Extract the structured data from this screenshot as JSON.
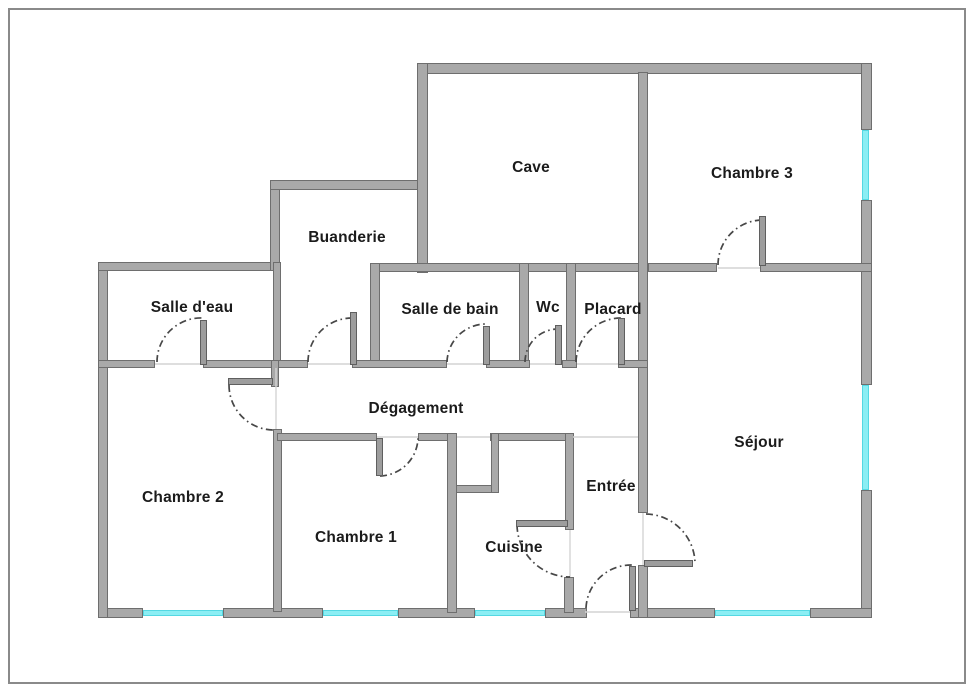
{
  "palette": {
    "wall_fill": "#a9a9a9",
    "wall_edge": "#6e6e6e",
    "window_color": "#8beef4",
    "window_edge": "#54d8e2",
    "arc_color": "#474747",
    "opening_line_color": "#d4d4d4",
    "label_color": "#1b1b1b",
    "frame_color": "#8a8a8a"
  },
  "rooms": [
    {
      "id": "cave",
      "label": "Cave",
      "cx": 531,
      "cy": 168
    },
    {
      "id": "chambre-3",
      "label": "Chambre 3",
      "cx": 752,
      "cy": 174
    },
    {
      "id": "buanderie",
      "label": "Buanderie",
      "cx": 347,
      "cy": 238
    },
    {
      "id": "salle-d-eau",
      "label": "Salle d'eau",
      "cx": 192,
      "cy": 308
    },
    {
      "id": "salle-de-bain",
      "label": "Salle de bain",
      "cx": 450,
      "cy": 310
    },
    {
      "id": "wc",
      "label": "Wc",
      "cx": 548,
      "cy": 308
    },
    {
      "id": "placard",
      "label": "Placard",
      "cx": 613,
      "cy": 310
    },
    {
      "id": "degagement",
      "label": "Dégagement",
      "cx": 416,
      "cy": 409
    },
    {
      "id": "chambre-2",
      "label": "Chambre 2",
      "cx": 183,
      "cy": 498
    },
    {
      "id": "chambre-1",
      "label": "Chambre 1",
      "cx": 356,
      "cy": 538
    },
    {
      "id": "cuisine",
      "label": "Cuisine",
      "cx": 514,
      "cy": 548
    },
    {
      "id": "entree",
      "label": "Entrée",
      "cx": 611,
      "cy": 487
    },
    {
      "id": "sejour",
      "label": "Séjour",
      "cx": 759,
      "cy": 443
    }
  ],
  "plan": {
    "walls": [
      {
        "x": 418,
        "y": 63,
        "w": 454,
        "h": 11
      },
      {
        "x": 861,
        "y": 63,
        "w": 11,
        "h": 67
      },
      {
        "x": 861,
        "y": 200,
        "w": 11,
        "h": 185
      },
      {
        "x": 861,
        "y": 490,
        "w": 11,
        "h": 128
      },
      {
        "x": 98,
        "y": 608,
        "w": 45,
        "h": 10
      },
      {
        "x": 223,
        "y": 608,
        "w": 100,
        "h": 10
      },
      {
        "x": 398,
        "y": 608,
        "w": 77,
        "h": 10
      },
      {
        "x": 545,
        "y": 608,
        "w": 42,
        "h": 10
      },
      {
        "x": 630,
        "y": 608,
        "w": 85,
        "h": 10
      },
      {
        "x": 810,
        "y": 608,
        "w": 62,
        "h": 10
      },
      {
        "x": 98,
        "y": 262,
        "w": 10,
        "h": 356
      },
      {
        "x": 98,
        "y": 262,
        "w": 182,
        "h": 9
      },
      {
        "x": 270,
        "y": 180,
        "w": 10,
        "h": 91
      },
      {
        "x": 270,
        "y": 180,
        "w": 158,
        "h": 10
      },
      {
        "x": 417,
        "y": 63,
        "w": 11,
        "h": 210
      },
      {
        "x": 370,
        "y": 263,
        "w": 278,
        "h": 9
      },
      {
        "x": 648,
        "y": 263,
        "w": 69,
        "h": 9
      },
      {
        "x": 760,
        "y": 263,
        "w": 112,
        "h": 9
      },
      {
        "x": 273,
        "y": 262,
        "w": 8,
        "h": 106
      },
      {
        "x": 370,
        "y": 263,
        "w": 10,
        "h": 105
      },
      {
        "x": 519,
        "y": 263,
        "w": 10,
        "h": 105
      },
      {
        "x": 566,
        "y": 263,
        "w": 10,
        "h": 105
      },
      {
        "x": 638,
        "y": 72,
        "w": 10,
        "h": 441
      },
      {
        "x": 638,
        "y": 565,
        "w": 10,
        "h": 53
      },
      {
        "x": 98,
        "y": 360,
        "w": 57,
        "h": 8
      },
      {
        "x": 203,
        "y": 360,
        "w": 105,
        "h": 8
      },
      {
        "x": 352,
        "y": 360,
        "w": 95,
        "h": 8
      },
      {
        "x": 486,
        "y": 360,
        "w": 44,
        "h": 8
      },
      {
        "x": 562,
        "y": 360,
        "w": 15,
        "h": 8
      },
      {
        "x": 618,
        "y": 360,
        "w": 30,
        "h": 8
      },
      {
        "x": 271,
        "y": 360,
        "w": 8,
        "h": 27
      },
      {
        "x": 273,
        "y": 429,
        "w": 9,
        "h": 183
      },
      {
        "x": 277,
        "y": 433,
        "w": 100,
        "h": 8
      },
      {
        "x": 418,
        "y": 433,
        "w": 39,
        "h": 8
      },
      {
        "x": 490,
        "y": 433,
        "w": 83,
        "h": 8
      },
      {
        "x": 449,
        "y": 433,
        "w": 8,
        "h": 60
      },
      {
        "x": 449,
        "y": 485,
        "w": 50,
        "h": 8
      },
      {
        "x": 491,
        "y": 433,
        "w": 8,
        "h": 60
      },
      {
        "x": 447,
        "y": 433,
        "w": 10,
        "h": 180
      },
      {
        "x": 565,
        "y": 433,
        "w": 9,
        "h": 97
      },
      {
        "x": 564,
        "y": 577,
        "w": 10,
        "h": 36
      }
    ],
    "windows": [
      {
        "x": 143,
        "y": 610,
        "w": 80,
        "h": 6
      },
      {
        "x": 323,
        "y": 610,
        "w": 75,
        "h": 6
      },
      {
        "x": 475,
        "y": 610,
        "w": 70,
        "h": 6
      },
      {
        "x": 715,
        "y": 610,
        "w": 95,
        "h": 6
      },
      {
        "x": 862,
        "y": 130,
        "w": 7,
        "h": 70
      },
      {
        "x": 862,
        "y": 385,
        "w": 7,
        "h": 105
      }
    ],
    "door_leaves": [
      {
        "x": 200,
        "y": 320,
        "w": 7,
        "h": 45
      },
      {
        "x": 350,
        "y": 312,
        "w": 7,
        "h": 53
      },
      {
        "x": 483,
        "y": 326,
        "w": 7,
        "h": 39
      },
      {
        "x": 555,
        "y": 325,
        "w": 7,
        "h": 40
      },
      {
        "x": 618,
        "y": 318,
        "w": 7,
        "h": 47
      },
      {
        "x": 759,
        "y": 216,
        "w": 7,
        "h": 50
      },
      {
        "x": 228,
        "y": 378,
        "w": 45,
        "h": 7
      },
      {
        "x": 376,
        "y": 438,
        "w": 7,
        "h": 38
      },
      {
        "x": 516,
        "y": 520,
        "w": 52,
        "h": 7
      },
      {
        "x": 644,
        "y": 560,
        "w": 49,
        "h": 7
      },
      {
        "x": 629,
        "y": 566,
        "w": 7,
        "h": 45
      }
    ],
    "door_arcs": [
      {
        "x1": 157,
        "y1": 362,
        "x2": 203,
        "y2": 318,
        "r": 44,
        "sweep": 1
      },
      {
        "x1": 308,
        "y1": 362,
        "x2": 352,
        "y2": 318,
        "r": 44,
        "sweep": 1
      },
      {
        "x1": 447,
        "y1": 362,
        "x2": 486,
        "y2": 324,
        "r": 39,
        "sweep": 1
      },
      {
        "x1": 525,
        "y1": 362,
        "x2": 558,
        "y2": 329,
        "r": 33,
        "sweep": 1
      },
      {
        "x1": 576,
        "y1": 362,
        "x2": 621,
        "y2": 318,
        "r": 45,
        "sweep": 1
      },
      {
        "x1": 718,
        "y1": 265,
        "x2": 762,
        "y2": 220,
        "r": 45,
        "sweep": 1
      },
      {
        "x1": 229,
        "y1": 385,
        "x2": 273,
        "y2": 430,
        "r": 45,
        "sweep": 0
      },
      {
        "x1": 380,
        "y1": 476,
        "x2": 418,
        "y2": 438,
        "r": 39,
        "sweep": 0
      },
      {
        "x1": 517,
        "y1": 525,
        "x2": 570,
        "y2": 577,
        "r": 53,
        "sweep": 0
      },
      {
        "x1": 646,
        "y1": 514,
        "x2": 695,
        "y2": 563,
        "r": 50,
        "sweep": 1
      },
      {
        "x1": 586,
        "y1": 608,
        "x2": 632,
        "y2": 565,
        "r": 45,
        "sweep": 1
      }
    ],
    "opening_lines": [
      {
        "x1": 276,
        "y1": 368,
        "x2": 276,
        "y2": 429
      },
      {
        "x1": 573,
        "y1": 437,
        "x2": 638,
        "y2": 437
      },
      {
        "x1": 643,
        "y1": 513,
        "x2": 643,
        "y2": 565
      },
      {
        "x1": 585,
        "y1": 612,
        "x2": 630,
        "y2": 612
      },
      {
        "x1": 457,
        "y1": 437,
        "x2": 490,
        "y2": 437
      },
      {
        "x1": 377,
        "y1": 437,
        "x2": 418,
        "y2": 437
      },
      {
        "x1": 155,
        "y1": 364,
        "x2": 203,
        "y2": 364
      },
      {
        "x1": 308,
        "y1": 364,
        "x2": 352,
        "y2": 364
      },
      {
        "x1": 447,
        "y1": 364,
        "x2": 486,
        "y2": 364
      },
      {
        "x1": 530,
        "y1": 364,
        "x2": 555,
        "y2": 364
      },
      {
        "x1": 577,
        "y1": 364,
        "x2": 618,
        "y2": 364
      },
      {
        "x1": 718,
        "y1": 268,
        "x2": 760,
        "y2": 268
      },
      {
        "x1": 570,
        "y1": 530,
        "x2": 570,
        "y2": 577
      }
    ]
  }
}
